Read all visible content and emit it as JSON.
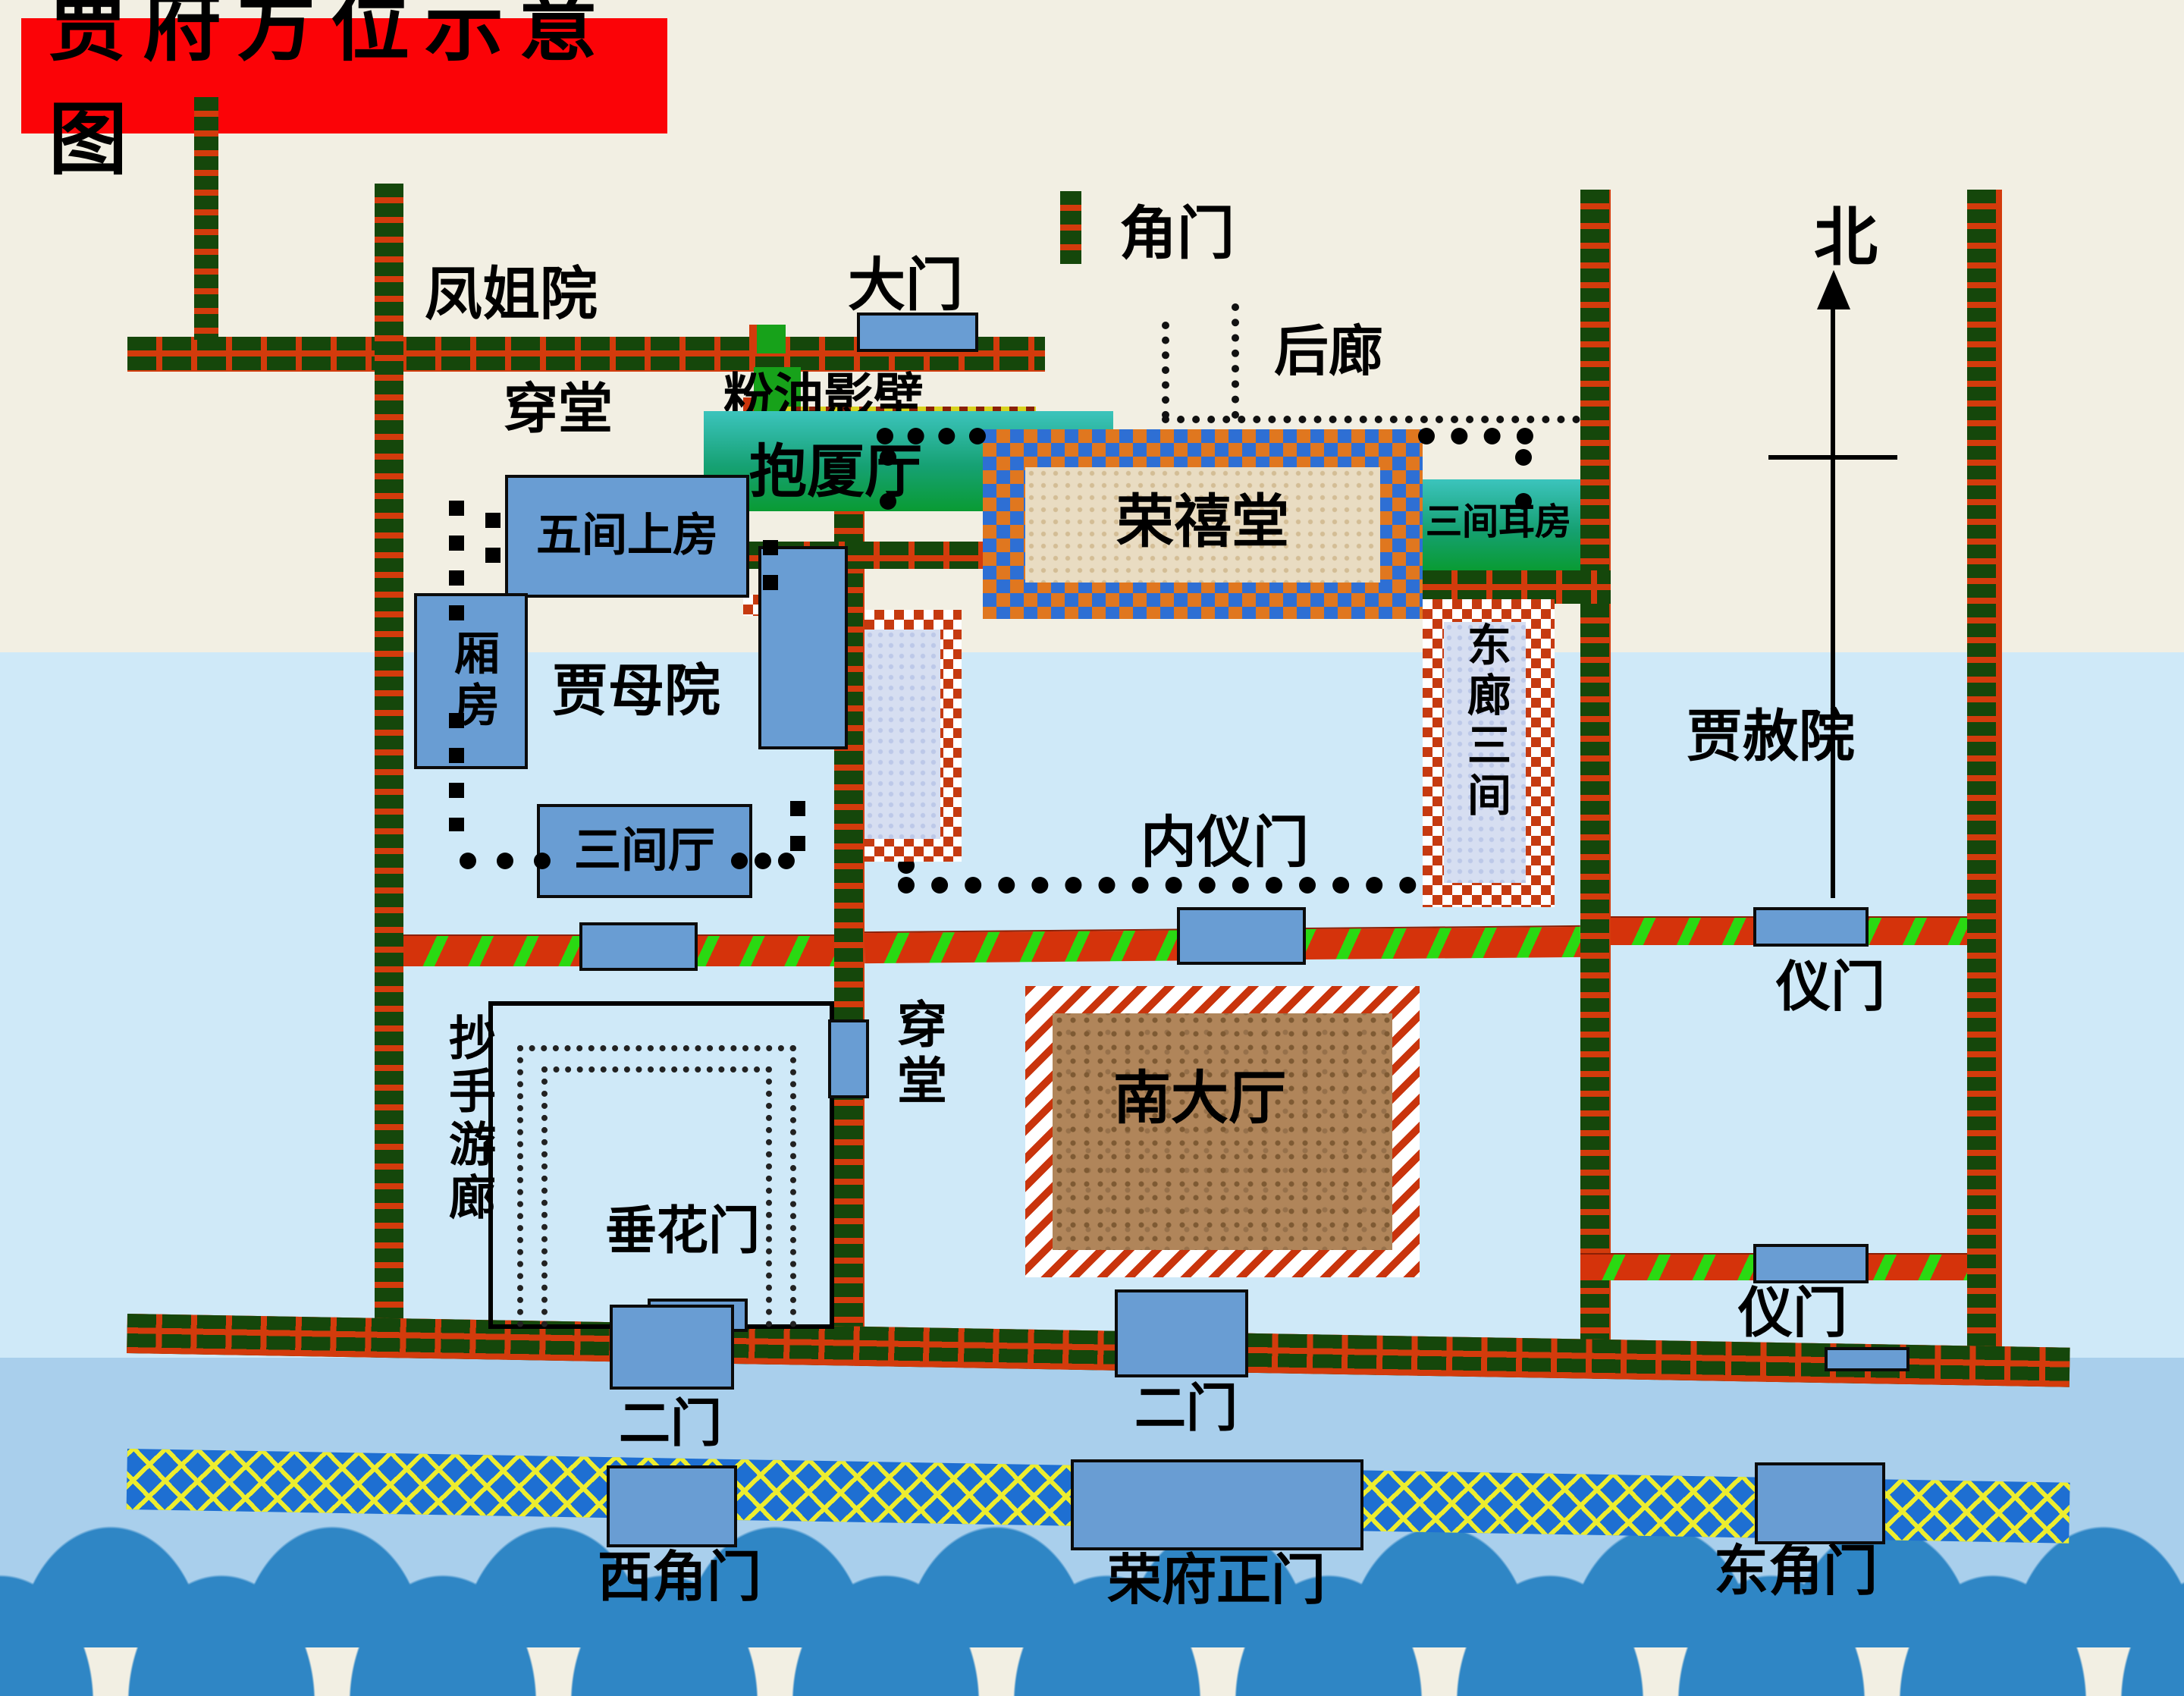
{
  "title": "贾府方位示意图",
  "compass": {
    "north": "北"
  },
  "labels": {
    "fengjieyuan": "凤姐院",
    "chuantang_north": "穿堂",
    "damen": "大门",
    "jiaomen": "角门",
    "fenyouyingbi": "粉油影壁",
    "baoshating": "抱厦厅",
    "houlang": "后廊",
    "sanjianerfang": "三间耳房",
    "rongxitang": "荣禧堂",
    "wujianshangfang": "五间上房",
    "xiangfang": "厢房",
    "jiamuyuan": "贾母院",
    "donglangsanjian": "东廊三间",
    "jiasheyuan": "贾赦院",
    "sanjianting": "三间厅",
    "neiyimen": "内仪门",
    "yimen_upper": "仪门",
    "yimen_lower": "仪门",
    "chuantang_south": "穿堂",
    "nandating": "南大厅",
    "chaoshouyoulang": "抄手游廊",
    "chuihuamen": "垂花门",
    "ermen_west": "二门",
    "ermen_east": "二门",
    "xijiaomen": "西角门",
    "rongfuzhengmen": "荣府正门",
    "dongjiaomen": "东角门"
  },
  "colors": {
    "title_bg": "#fb0307",
    "wall_brick_green": "#15470b",
    "wall_brick_red": "#d33b0c",
    "stripe_green": "#2ad912",
    "street_blue": "#1e6fd2",
    "street_yellow": "#eded2f",
    "frame_blue": "#2e6fd4",
    "frame_orange": "#e0771f",
    "room_blue": "#699dd3",
    "bg_cream": "#f2efe3",
    "bg_lightblue": "#cfe9f8",
    "bg_medblue": "#a9cfec",
    "wave_blue": "#2f86c5",
    "teal_top": "#3cc4bd",
    "teal_bottom": "#099b33"
  }
}
